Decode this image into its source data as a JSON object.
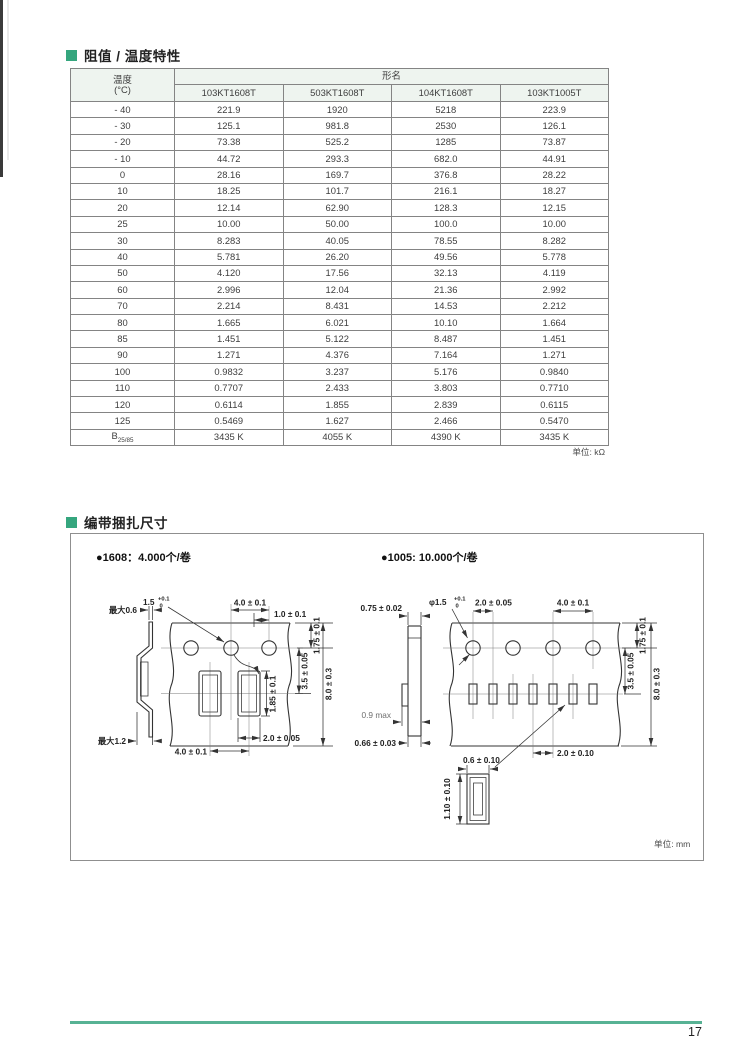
{
  "page": {
    "number": "17"
  },
  "resistance_section": {
    "title": "阻值 / 温度特性",
    "unit_note": "单位:  kΩ",
    "table": {
      "temp_header_line1": "温度",
      "temp_header_line2": "(°C)",
      "group_header": "形名",
      "models": [
        "103KT1608T",
        "503KT1608T",
        "104KT1608T",
        "103KT1005T"
      ],
      "rows": [
        {
          "t": "- 40",
          "v": [
            "221.9",
            "1920",
            "5218",
            "223.9"
          ]
        },
        {
          "t": "- 30",
          "v": [
            "125.1",
            "981.8",
            "2530",
            "126.1"
          ]
        },
        {
          "t": "- 20",
          "v": [
            "73.38",
            "525.2",
            "1285",
            "73.87"
          ]
        },
        {
          "t": "- 10",
          "v": [
            "44.72",
            "293.3",
            "682.0",
            "44.91"
          ]
        },
        {
          "t": "0",
          "v": [
            "28.16",
            "169.7",
            "376.8",
            "28.22"
          ]
        },
        {
          "t": "10",
          "v": [
            "18.25",
            "101.7",
            "216.1",
            "18.27"
          ]
        },
        {
          "t": "20",
          "v": [
            "12.14",
            "62.90",
            "128.3",
            "12.15"
          ]
        },
        {
          "t": "25",
          "v": [
            "10.00",
            "50.00",
            "100.0",
            "10.00"
          ]
        },
        {
          "t": "30",
          "v": [
            "8.283",
            "40.05",
            "78.55",
            "8.282"
          ]
        },
        {
          "t": "40",
          "v": [
            "5.781",
            "26.20",
            "49.56",
            "5.778"
          ]
        },
        {
          "t": "50",
          "v": [
            "4.120",
            "17.56",
            "32.13",
            "4.119"
          ]
        },
        {
          "t": "60",
          "v": [
            "2.996",
            "12.04",
            "21.36",
            "2.992"
          ]
        },
        {
          "t": "70",
          "v": [
            "2.214",
            "8.431",
            "14.53",
            "2.212"
          ]
        },
        {
          "t": "80",
          "v": [
            "1.665",
            "6.021",
            "10.10",
            "1.664"
          ]
        },
        {
          "t": "85",
          "v": [
            "1.451",
            "5.122",
            "8.487",
            "1.451"
          ]
        },
        {
          "t": "90",
          "v": [
            "1.271",
            "4.376",
            "7.164",
            "1.271"
          ]
        },
        {
          "t": "100",
          "v": [
            "0.9832",
            "3.237",
            "5.176",
            "0.9840"
          ]
        },
        {
          "t": "110",
          "v": [
            "0.7707",
            "2.433",
            "3.803",
            "0.7710"
          ]
        },
        {
          "t": "120",
          "v": [
            "0.6114",
            "1.855",
            "2.839",
            "0.6115"
          ]
        },
        {
          "t": "125",
          "v": [
            "0.5469",
            "1.627",
            "2.466",
            "0.5470"
          ]
        }
      ],
      "b_row": {
        "label": "B",
        "sub": "25/85",
        "values": [
          "3435 K",
          "4055 K",
          "4390 K",
          "3435 K"
        ]
      }
    }
  },
  "packaging_section": {
    "title": "编带捆扎尺寸",
    "unit_note": "单位:  mm",
    "reel_1608": {
      "label": "●1608：4.000个/卷",
      "max_top": "最大0.6",
      "max_bottom": "最大1.2",
      "hole_dia": "1.5",
      "hole_tol_plus": "+0.1",
      "hole_tol_zero": "0",
      "hole_pitch": "4.0 ± 0.1",
      "hole_offset": "1.0 ± 0.1",
      "edge_to_hole": "1.75 ± 0.1",
      "hole_to_pocket": "3.5 ± 0.05",
      "tape_width": "8.0 ± 0.3",
      "pocket_length": "1.85 ± 0.1",
      "pocket_width": "2.0 ± 0.05",
      "pocket_pitch": "4.0 ± 0.1"
    },
    "reel_1005": {
      "label": "●1005: 10.000个/卷",
      "tape_thickness": "0.75 ± 0.02",
      "max_thickness": "0.9 max",
      "bottom_thickness": "0.66 ± 0.03",
      "hole_dia": "φ1.5",
      "hole_tol_plus": "+0.1",
      "hole_tol_zero": "0",
      "hole_to_pocket_pitch": "2.0 ± 0.05",
      "hole_pitch": "4.0 ± 0.1",
      "edge_to_hole": "1.75 ± 0.1",
      "hole_to_pocket": "3.5 ± 0.05",
      "tape_width": "8.0 ± 0.3",
      "pocket_pitch": "2.0 ± 0.10",
      "pocket_width": "0.6 ± 0.10",
      "pocket_height": "1.10 ± 0.10"
    }
  }
}
